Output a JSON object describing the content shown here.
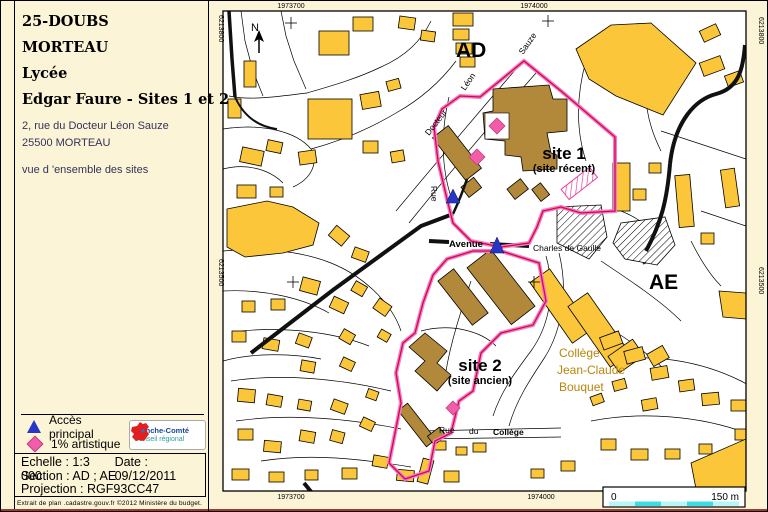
{
  "panel": {
    "dept": "25-DOUBS",
    "city": "MORTEAU",
    "school_type": "Lycée",
    "school_name": "Edgar Faure - Sites 1 et 2",
    "address_line1": "2, rue du Docteur Léon Sauze",
    "address_line2": "25500 MORTEAU",
    "view_label": "vue d 'ensemble des sites",
    "legend": {
      "access": "Accès principal",
      "artistique": "1% artistique"
    },
    "logo": {
      "line1": "Franche-Comté",
      "line2": "Conseil régional"
    },
    "info": {
      "scale": "Echelle : 1:3 000",
      "date": "Date : 09/12/2011",
      "section": "Section : AD ; AE",
      "projection": "Projection : RGF93CC47"
    },
    "credit": "Extrait de plan .cadastre.gouv.fr ©2012 Ministère du budget."
  },
  "map": {
    "coords": {
      "top_left": "1973700",
      "top_right": "1974000",
      "bottom_left": "1973700",
      "bottom_right": "1974000",
      "left_top": "6213800",
      "left_bottom": "6213500",
      "right_top": "6213800",
      "right_bottom": "6213500"
    },
    "north_label": "N",
    "sections": {
      "ad": "AD",
      "ae": "AE"
    },
    "site1": {
      "title": "site 1",
      "subtitle": "(site récent)"
    },
    "site2": {
      "title": "site 2",
      "subtitle": "(site ancien)"
    },
    "college": {
      "line1": "Collège",
      "line2": "Jean-Claude",
      "line3": "Bouquet"
    },
    "streets": {
      "docteur": "Docteur",
      "leon": "Léon",
      "sauze": "Sauze",
      "rue": "Rue",
      "avenue": "Avenue",
      "cdg": "Charles de Gaulle",
      "rue_college_1": "Rue",
      "rue_college_2": "du",
      "rue_college_3": "Collège"
    },
    "scalebar": {
      "zero": "0",
      "max": "150 m"
    }
  },
  "colors": {
    "page_bg": "#FCF4D6",
    "building_yellow": "#FBC639",
    "school_khaki": "#B2883A",
    "boundary_pink": "#F281B5",
    "boundary_crimson": "#D4006A",
    "marker_blue": "#2836C8",
    "marker_pink": "#F25CA8",
    "college_text": "#B8860B",
    "scalebar_cyan_light": "#B6F6F4",
    "scalebar_cyan_dark": "#3ADCE6",
    "bottom_line_red": "#A23B2E"
  }
}
